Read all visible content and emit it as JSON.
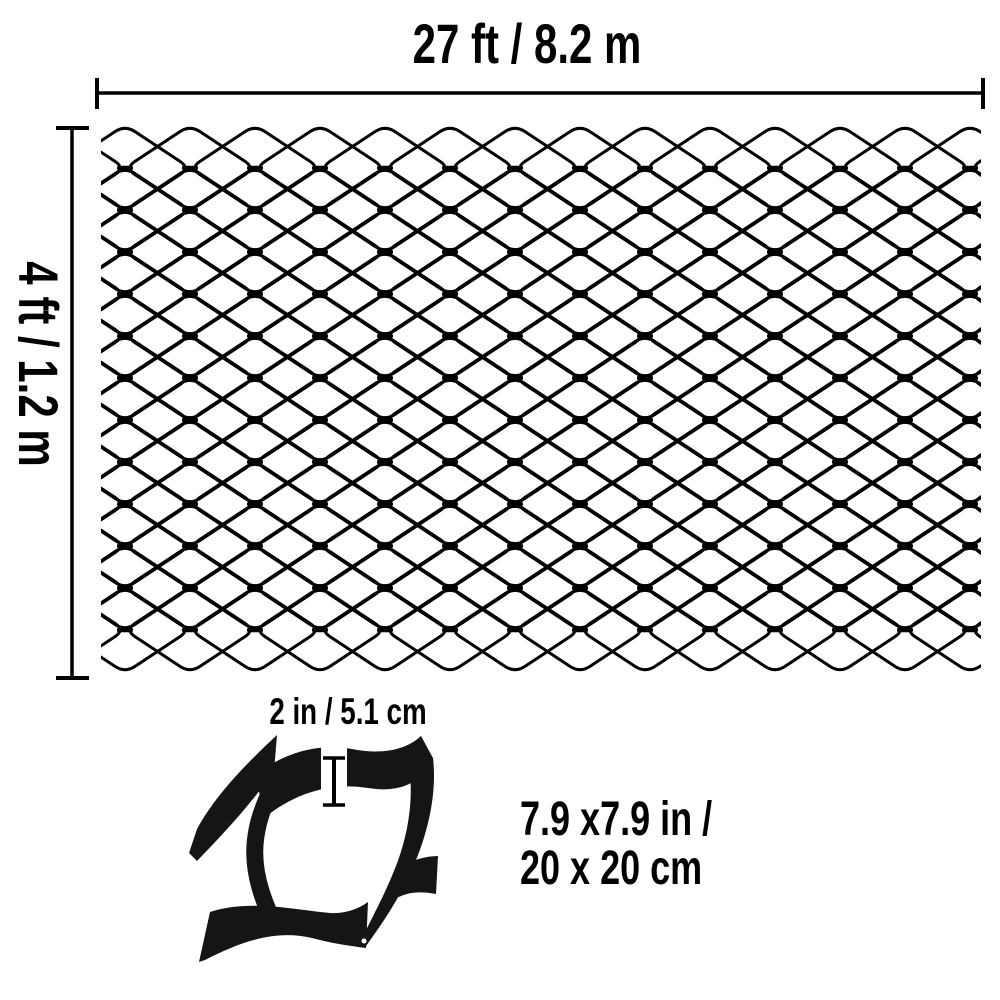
{
  "labels": {
    "width_label": "27 ft / 8.2 m",
    "height_label": "4 ft / 1.2 m",
    "cell_depth_label": "2 in / 5.1 cm",
    "cell_size_line1": "7.9 x7.9 in /",
    "cell_size_line2": "20 x 20 cm"
  },
  "colors": {
    "line": "#000000",
    "text": "#000000",
    "geocell_fill": "#151515",
    "background": "#ffffff"
  },
  "mesh": {
    "diamond_width": 130,
    "diamond_height": 86,
    "col_pitch": 65,
    "row_pitch": 42,
    "columns": 16,
    "rows": 12,
    "origin_x": 60,
    "origin_y": 168,
    "corner_radius": 12,
    "stroke_width": 3,
    "color": "#000000",
    "clip": {
      "x": 101,
      "y": 117,
      "w": 880,
      "h": 559
    }
  }
}
